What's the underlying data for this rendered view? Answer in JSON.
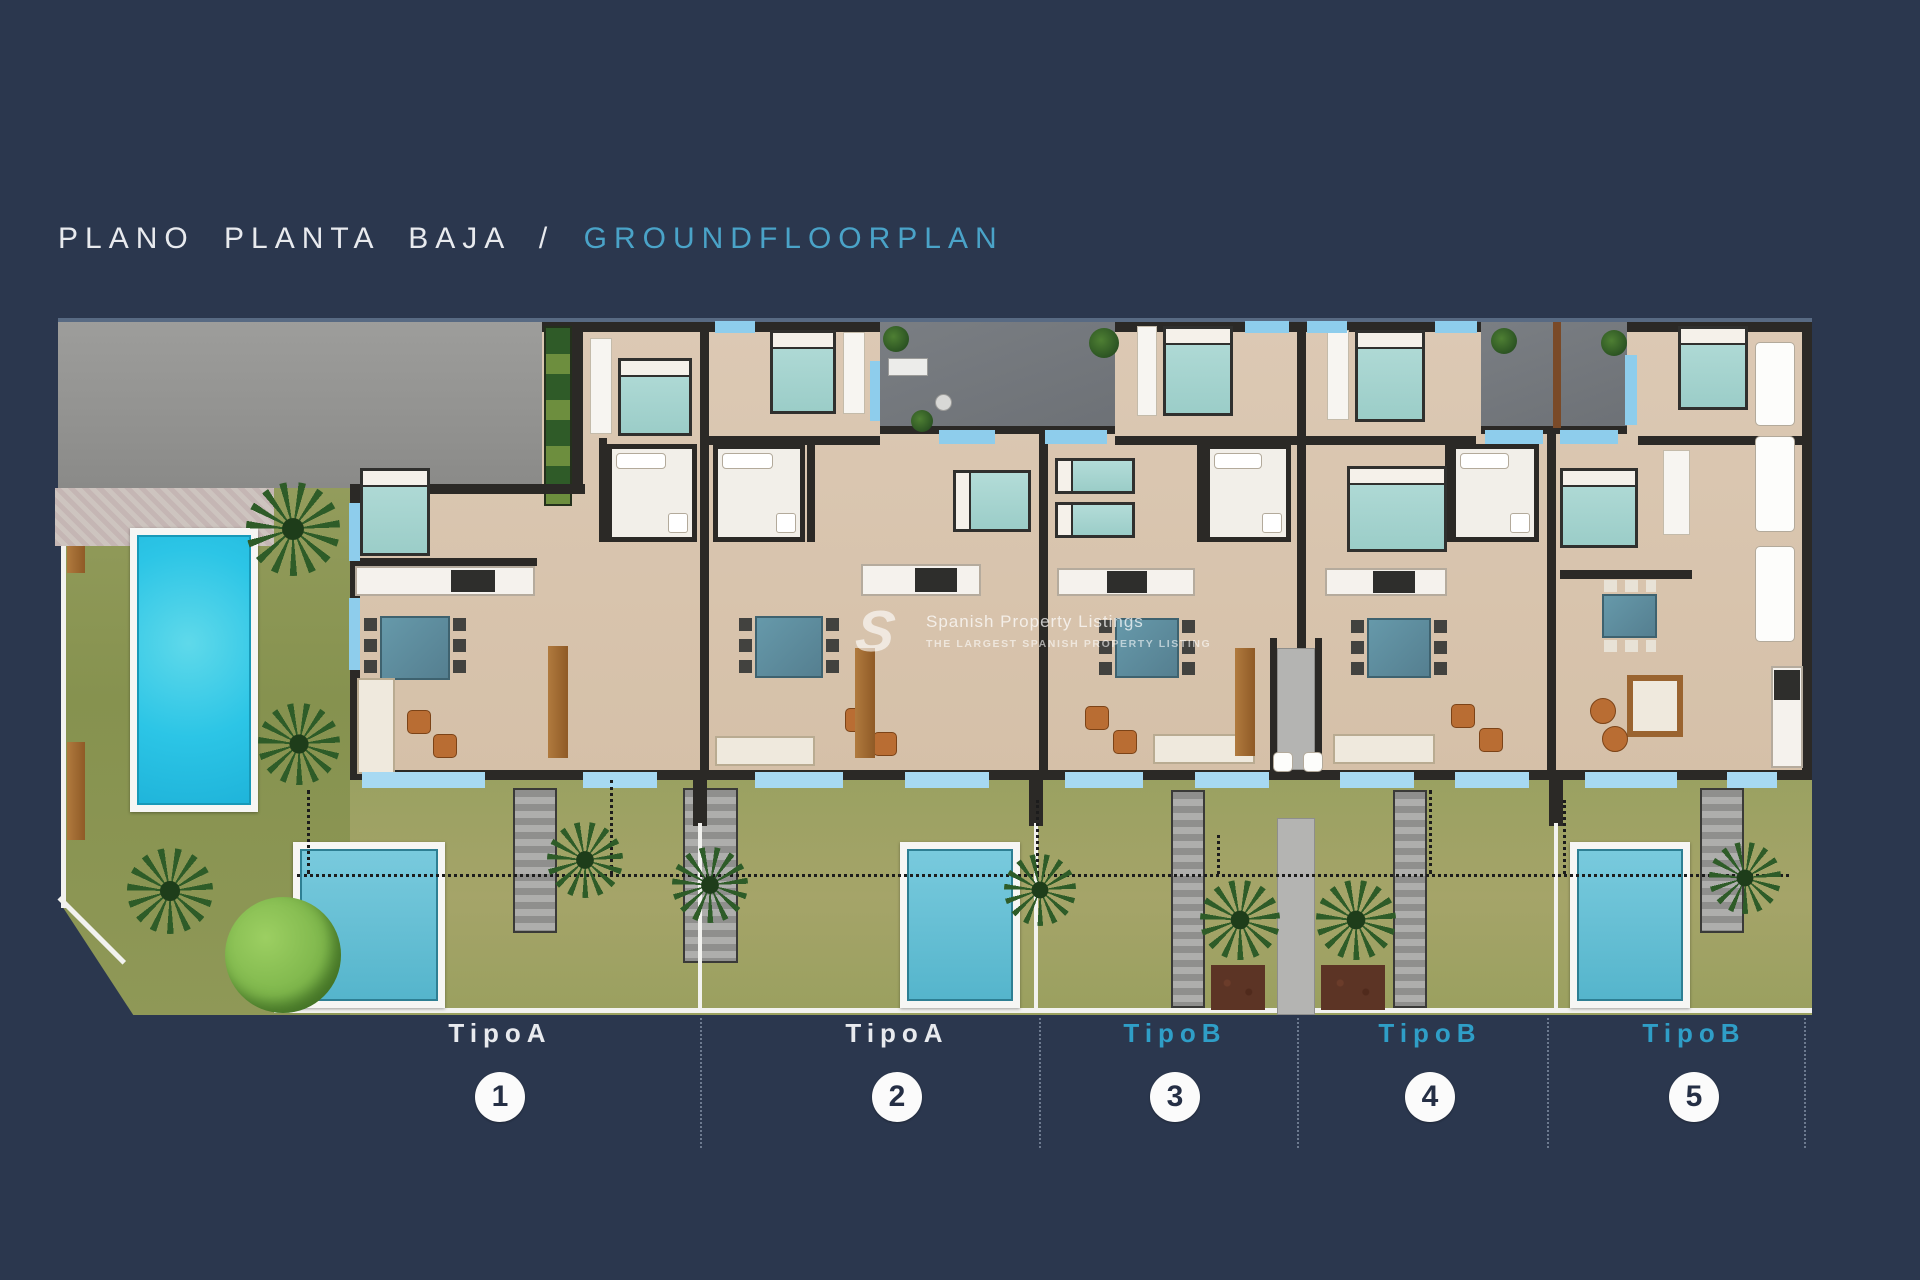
{
  "title": {
    "primary": "PLANO PLANTA BAJA",
    "separator": "/",
    "secondary": "GROUNDFLOORPLAN"
  },
  "watermark": {
    "logo": "S",
    "line1": "Spanish Property Listings",
    "line2": "THE LARGEST SPANISH PROPERTY LISTING"
  },
  "legend": {
    "units": [
      {
        "label": "TipoA",
        "number": "1",
        "type": "A"
      },
      {
        "label": "TipoA",
        "number": "2",
        "type": "A"
      },
      {
        "label": "TipoB",
        "number": "3",
        "type": "B"
      },
      {
        "label": "TipoB",
        "number": "4",
        "type": "B"
      },
      {
        "label": "TipoB",
        "number": "5",
        "type": "B"
      }
    ],
    "type_a_color": "#e8eaee",
    "type_b_color": "#2f9ec7"
  },
  "colors": {
    "background": "#2b374e",
    "title_primary": "#e8eaee",
    "title_accent": "#4aa3c8",
    "walls": "#2b2926",
    "floor": "#d9c5ae",
    "window_glass": "#8ecdec",
    "garden": "#99a061",
    "main_pool": "#2cc5e6",
    "plunge_pool": "#62bfd5",
    "driveway": "#959593"
  }
}
